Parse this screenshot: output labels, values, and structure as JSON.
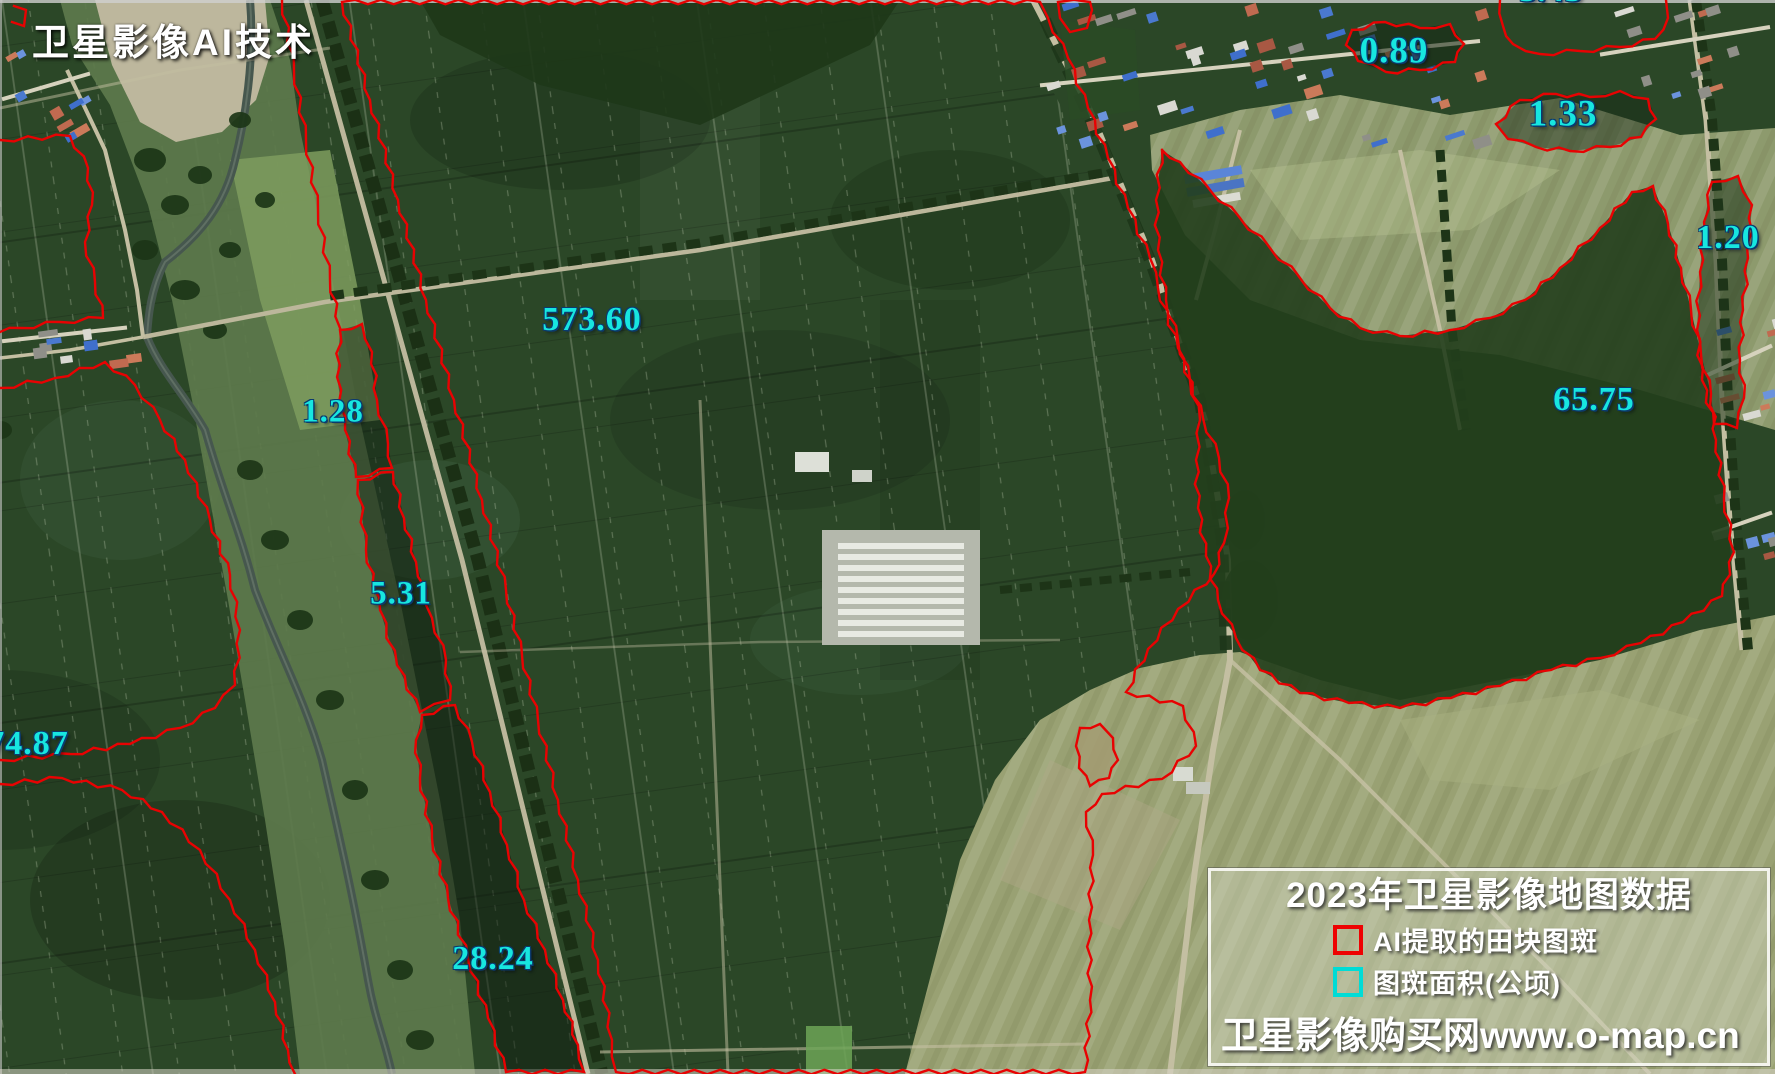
{
  "watermark": {
    "text": "卫星影像AI技术"
  },
  "legend": {
    "title": "2023年卫星影像地图数据",
    "items": [
      {
        "label": "AI提取的田块图斑",
        "swatch": "#ee0202"
      },
      {
        "label": "图斑面积(公顷)",
        "swatch": "#00dcd6"
      }
    ],
    "footer": "卫星影像购买网www.o-map.cn"
  },
  "colors": {
    "parcel_outline": "#e80202",
    "area_label": "#17e6e0"
  },
  "map": {
    "labels": [
      {
        "value": "3.43",
        "cx": 1551,
        "cy": -9,
        "size": 34
      },
      {
        "value": "0.89",
        "cx": 1394,
        "cy": 51,
        "size": 37
      },
      {
        "value": "1.33",
        "cx": 1563,
        "cy": 114,
        "size": 37
      },
      {
        "value": "1.20",
        "cx": 1728,
        "cy": 238,
        "size": 34
      },
      {
        "value": "65.75",
        "cx": 1594,
        "cy": 400,
        "size": 34
      },
      {
        "value": "573.60",
        "cx": 592,
        "cy": 320,
        "size": 34
      },
      {
        "value": "1.28",
        "cx": 333,
        "cy": 412,
        "size": 33
      },
      {
        "value": "5.31",
        "cx": 401,
        "cy": 594,
        "size": 33
      },
      {
        "value": "28.24",
        "cx": 493,
        "cy": 959,
        "size": 34
      },
      {
        "value": "74.87",
        "cx": 28,
        "cy": 744,
        "size": 34
      }
    ],
    "outlines": [
      {
        "name": "central-parcel",
        "closed": true,
        "fill": null,
        "points": [
          [
            342,
            2
          ],
          [
            370,
            100
          ],
          [
            398,
            200
          ],
          [
            426,
            300
          ],
          [
            454,
            400
          ],
          [
            482,
            500
          ],
          [
            506,
            590
          ],
          [
            522,
            655
          ],
          [
            538,
            720
          ],
          [
            558,
            800
          ],
          [
            578,
            880
          ],
          [
            598,
            960
          ],
          [
            612,
            1040
          ],
          [
            616,
            1072
          ],
          [
            1085,
            1072
          ],
          [
            1090,
            1000
          ],
          [
            1089,
            920
          ],
          [
            1093,
            855
          ],
          [
            1086,
            812
          ],
          [
            1102,
            794
          ],
          [
            1162,
            779
          ],
          [
            1196,
            746
          ],
          [
            1183,
            706
          ],
          [
            1126,
            692
          ],
          [
            1148,
            649
          ],
          [
            1178,
            609
          ],
          [
            1214,
            574
          ],
          [
            1224,
            543
          ],
          [
            1229,
            498
          ],
          [
            1219,
            458
          ],
          [
            1203,
            418
          ],
          [
            1178,
            348
          ],
          [
            1158,
            288
          ],
          [
            1150,
            258
          ],
          [
            1128,
            208
          ],
          [
            1108,
            158
          ],
          [
            1088,
            108
          ],
          [
            1068,
            58
          ],
          [
            1048,
            18
          ],
          [
            1040,
            2
          ],
          [
            342,
            2
          ]
        ]
      },
      {
        "name": "strip-chain-top",
        "closed": false,
        "fill": null,
        "points": [
          [
            282,
            0
          ],
          [
            294,
            70
          ],
          [
            306,
            140
          ],
          [
            318,
            210
          ],
          [
            330,
            280
          ],
          [
            340,
            328
          ]
        ]
      },
      {
        "name": "parcel-1-28",
        "closed": true,
        "fill": "rgba(18,34,20,0.45)",
        "points": [
          [
            340,
            330
          ],
          [
            362,
            324
          ],
          [
            372,
            352
          ],
          [
            377,
            400
          ],
          [
            388,
            444
          ],
          [
            392,
            468
          ],
          [
            356,
            477
          ],
          [
            345,
            430
          ],
          [
            337,
            377
          ],
          [
            340,
            330
          ]
        ]
      },
      {
        "name": "parcel-5-31",
        "closed": true,
        "fill": "rgba(14,28,16,0.5)",
        "points": [
          [
            358,
            480
          ],
          [
            393,
            472
          ],
          [
            404,
            518
          ],
          [
            416,
            562
          ],
          [
            432,
            618
          ],
          [
            446,
            660
          ],
          [
            450,
            700
          ],
          [
            420,
            712
          ],
          [
            397,
            665
          ],
          [
            380,
            610
          ],
          [
            366,
            550
          ],
          [
            358,
            480
          ]
        ]
      },
      {
        "name": "parcel-28-24",
        "closed": true,
        "fill": "rgba(12,24,14,0.5)",
        "points": [
          [
            422,
            715
          ],
          [
            455,
            705
          ],
          [
            472,
            742
          ],
          [
            490,
            792
          ],
          [
            507,
            845
          ],
          [
            524,
            900
          ],
          [
            545,
            950
          ],
          [
            563,
            1000
          ],
          [
            578,
            1045
          ],
          [
            584,
            1072
          ],
          [
            506,
            1072
          ],
          [
            488,
            1018
          ],
          [
            468,
            958
          ],
          [
            448,
            898
          ],
          [
            432,
            838
          ],
          [
            420,
            778
          ],
          [
            416,
            740
          ],
          [
            422,
            715
          ]
        ]
      },
      {
        "name": "parcel-65-75",
        "closed": true,
        "fill": "rgba(34,62,28,0.9)",
        "points": [
          [
            1162,
            150
          ],
          [
            1180,
            162
          ],
          [
            1210,
            190
          ],
          [
            1240,
            218
          ],
          [
            1270,
            248
          ],
          [
            1300,
            278
          ],
          [
            1330,
            308
          ],
          [
            1360,
            328
          ],
          [
            1400,
            336
          ],
          [
            1450,
            330
          ],
          [
            1490,
            318
          ],
          [
            1525,
            300
          ],
          [
            1560,
            268
          ],
          [
            1600,
            228
          ],
          [
            1632,
            192
          ],
          [
            1653,
            186
          ],
          [
            1668,
            224
          ],
          [
            1681,
            268
          ],
          [
            1691,
            310
          ],
          [
            1701,
            354
          ],
          [
            1711,
            394
          ],
          [
            1716,
            440
          ],
          [
            1724,
            498
          ],
          [
            1734,
            552
          ],
          [
            1722,
            596
          ],
          [
            1683,
            622
          ],
          [
            1641,
            643
          ],
          [
            1600,
            658
          ],
          [
            1551,
            670
          ],
          [
            1500,
            686
          ],
          [
            1451,
            698
          ],
          [
            1400,
            708
          ],
          [
            1349,
            703
          ],
          [
            1300,
            693
          ],
          [
            1260,
            670
          ],
          [
            1236,
            638
          ],
          [
            1218,
            600
          ],
          [
            1206,
            556
          ],
          [
            1198,
            508
          ],
          [
            1196,
            460
          ],
          [
            1200,
            420
          ],
          [
            1190,
            380
          ],
          [
            1178,
            340
          ],
          [
            1166,
            300
          ],
          [
            1158,
            250
          ],
          [
            1156,
            200
          ],
          [
            1162,
            150
          ]
        ]
      },
      {
        "name": "parcel-1-20",
        "closed": true,
        "fill": "rgba(30,52,26,0.55)",
        "points": [
          [
            1712,
            182
          ],
          [
            1738,
            176
          ],
          [
            1752,
            205
          ],
          [
            1748,
            258
          ],
          [
            1743,
            310
          ],
          [
            1740,
            360
          ],
          [
            1744,
            398
          ],
          [
            1737,
            428
          ],
          [
            1714,
            424
          ],
          [
            1702,
            380
          ],
          [
            1697,
            330
          ],
          [
            1700,
            272
          ],
          [
            1704,
            222
          ],
          [
            1712,
            182
          ]
        ]
      },
      {
        "name": "parcel-0-89",
        "closed": true,
        "fill": "rgba(20,38,20,0.55)",
        "points": [
          [
            1352,
            30
          ],
          [
            1385,
            22
          ],
          [
            1420,
            28
          ],
          [
            1450,
            24
          ],
          [
            1464,
            44
          ],
          [
            1455,
            62
          ],
          [
            1420,
            70
          ],
          [
            1386,
            72
          ],
          [
            1358,
            61
          ],
          [
            1346,
            45
          ],
          [
            1352,
            30
          ]
        ]
      },
      {
        "name": "parcel-1-33",
        "closed": true,
        "fill": "rgba(20,38,20,0.45)",
        "points": [
          [
            1496,
            124
          ],
          [
            1520,
            100
          ],
          [
            1556,
            94
          ],
          [
            1590,
            97
          ],
          [
            1620,
            91
          ],
          [
            1648,
            99
          ],
          [
            1656,
            119
          ],
          [
            1641,
            137
          ],
          [
            1610,
            147
          ],
          [
            1570,
            151
          ],
          [
            1536,
            147
          ],
          [
            1508,
            139
          ],
          [
            1496,
            124
          ]
        ]
      },
      {
        "name": "parcel-3-43-cut",
        "closed": false,
        "fill": null,
        "points": [
          [
            1500,
            0
          ],
          [
            1503,
            26
          ],
          [
            1513,
            44
          ],
          [
            1540,
            54
          ],
          [
            1580,
            51
          ],
          [
            1620,
            47
          ],
          [
            1655,
            39
          ],
          [
            1668,
            18
          ],
          [
            1666,
            0
          ]
        ]
      },
      {
        "name": "parcel-top-right-small",
        "closed": true,
        "fill": null,
        "points": [
          [
            1058,
            2
          ],
          [
            1060,
            18
          ],
          [
            1070,
            32
          ],
          [
            1087,
            28
          ],
          [
            1092,
            10
          ],
          [
            1090,
            2
          ],
          [
            1058,
            2
          ]
        ]
      },
      {
        "name": "parcel-small-tan",
        "closed": true,
        "fill": "rgba(163,155,114,0.85)",
        "points": [
          [
            1080,
            728
          ],
          [
            1100,
            724
          ],
          [
            1113,
            738
          ],
          [
            1118,
            760
          ],
          [
            1109,
            778
          ],
          [
            1090,
            786
          ],
          [
            1079,
            768
          ],
          [
            1076,
            746
          ],
          [
            1080,
            728
          ]
        ]
      },
      {
        "name": "parcel-left-top",
        "closed": false,
        "fill": null,
        "points": [
          [
            0,
            140
          ],
          [
            70,
            136
          ],
          [
            88,
            168
          ],
          [
            92,
            205
          ],
          [
            85,
            242
          ],
          [
            95,
            282
          ],
          [
            103,
            318
          ],
          [
            60,
            322
          ],
          [
            20,
            328
          ],
          [
            0,
            332
          ]
        ]
      },
      {
        "name": "parcel-74-87",
        "closed": false,
        "fill": null,
        "points": [
          [
            0,
            388
          ],
          [
            55,
            378
          ],
          [
            105,
            362
          ],
          [
            135,
            385
          ],
          [
            160,
            420
          ],
          [
            185,
            460
          ],
          [
            210,
            520
          ],
          [
            230,
            575
          ],
          [
            240,
            630
          ],
          [
            235,
            685
          ],
          [
            215,
            708
          ],
          [
            180,
            728
          ],
          [
            130,
            744
          ],
          [
            70,
            754
          ],
          [
            0,
            760
          ]
        ]
      },
      {
        "name": "parcel-bottom-left",
        "closed": false,
        "fill": null,
        "points": [
          [
            0,
            784
          ],
          [
            62,
            778
          ],
          [
            122,
            790
          ],
          [
            162,
            812
          ],
          [
            200,
            850
          ],
          [
            230,
            900
          ],
          [
            255,
            950
          ],
          [
            275,
            1002
          ],
          [
            288,
            1050
          ],
          [
            295,
            1074
          ]
        ]
      },
      {
        "name": "corner-fragment",
        "closed": false,
        "fill": null,
        "points": [
          [
            14,
            6
          ],
          [
            26,
            10
          ],
          [
            24,
            26
          ],
          [
            12,
            22
          ]
        ]
      }
    ]
  }
}
